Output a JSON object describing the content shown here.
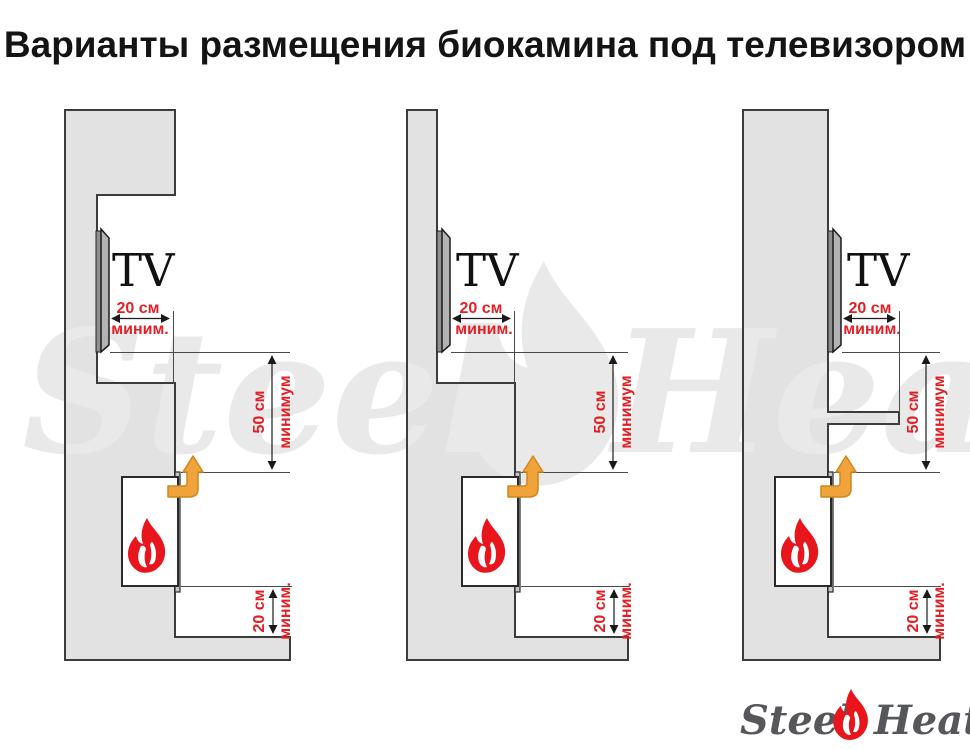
{
  "title": "Варианты размещения биокамина под телевизором",
  "watermark": {
    "word_left": "Steel",
    "word_right": "Heat",
    "flame_icon": "flame-icon"
  },
  "logo": {
    "word_left": "Steel",
    "word_right": "Heat",
    "flame_icon": "flame-icon"
  },
  "colors": {
    "dimension_red": "#e31f24",
    "flame_red": "#e8151d",
    "vent_arrow_orange": "#f1a33b",
    "wall_fill": "#e2e2e2",
    "wall_outline": "#3c3c3c",
    "watermark_gray": "#e9e9e9",
    "logo_gray": "#56575a",
    "fireplace_box": "#ffffff"
  },
  "diagrams": [
    {
      "variant": "tv-in-niche-with-top-overhang",
      "tv_label": "TV",
      "dim_tv_depth": {
        "value": "20 см",
        "qualifier": "миним."
      },
      "dim_clearance": {
        "value": "50 см",
        "qualifier": "минимум"
      },
      "dim_bottom": {
        "value": "20 см",
        "qualifier": "миним."
      }
    },
    {
      "variant": "tv-on-flat-wall",
      "tv_label": "TV",
      "dim_tv_depth": {
        "value": "20 см",
        "qualifier": "миним."
      },
      "dim_clearance": {
        "value": "50 см",
        "qualifier": "минимум"
      },
      "dim_bottom": {
        "value": "20 см",
        "qualifier": "миним."
      }
    },
    {
      "variant": "tv-on-wall-with-mantel-shelf",
      "tv_label": "TV",
      "dim_tv_depth": {
        "value": "20 см",
        "qualifier": "миним."
      },
      "dim_clearance": {
        "value": "50 см",
        "qualifier": "минимум"
      },
      "dim_bottom": {
        "value": "20 см",
        "qualifier": "миним."
      }
    }
  ]
}
